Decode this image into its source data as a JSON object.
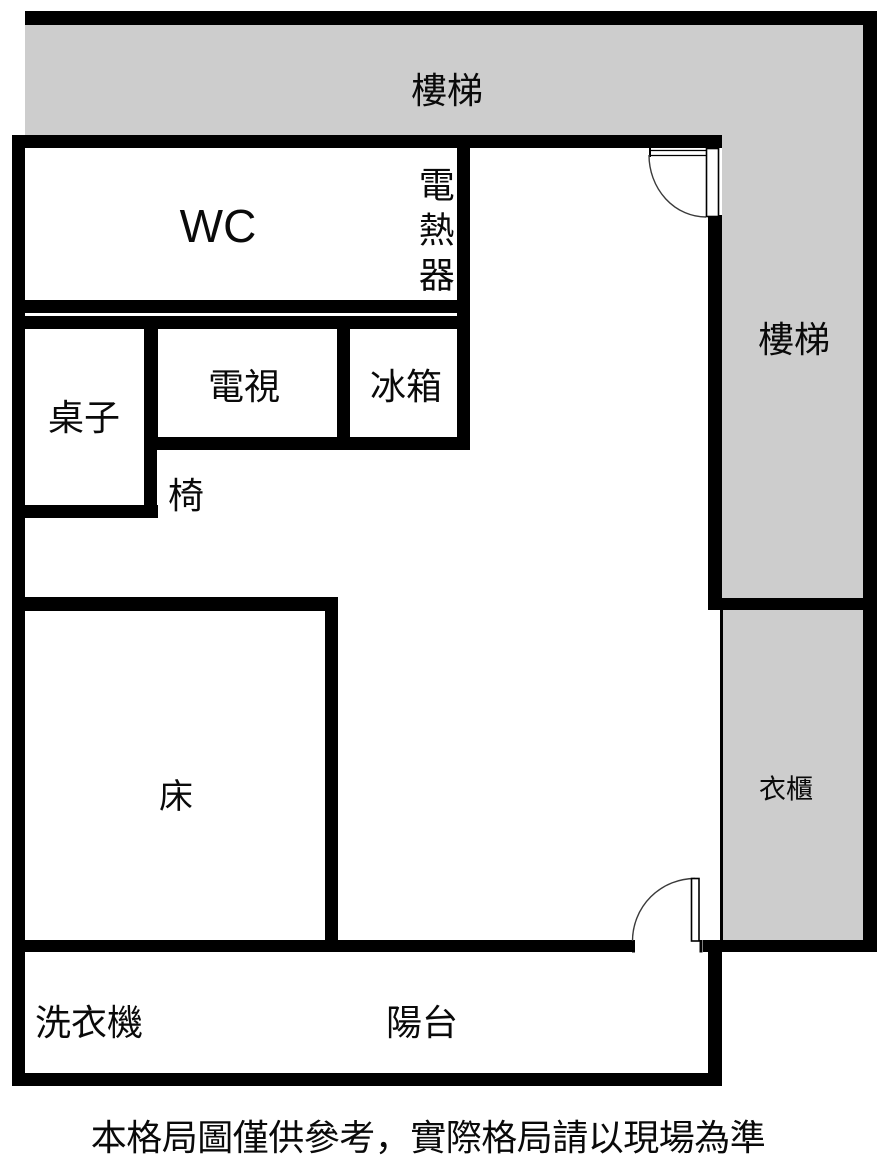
{
  "floorplan": {
    "caption": "本格局圖僅供參考，實際格局請以現場為準",
    "rooms": {
      "stairs_top": "樓梯",
      "stairs_right": "樓梯",
      "wc": "WC",
      "water_heater": "電熱器",
      "table": "桌子",
      "tv": "電視",
      "fridge": "冰箱",
      "chair": "椅",
      "bed": "床",
      "wardrobe": "衣櫃",
      "washing_machine": "洗衣機",
      "balcony": "陽台"
    },
    "colors": {
      "wall": "#000000",
      "stairs_fill": "#cdcdcd",
      "floor": "#ffffff"
    }
  }
}
